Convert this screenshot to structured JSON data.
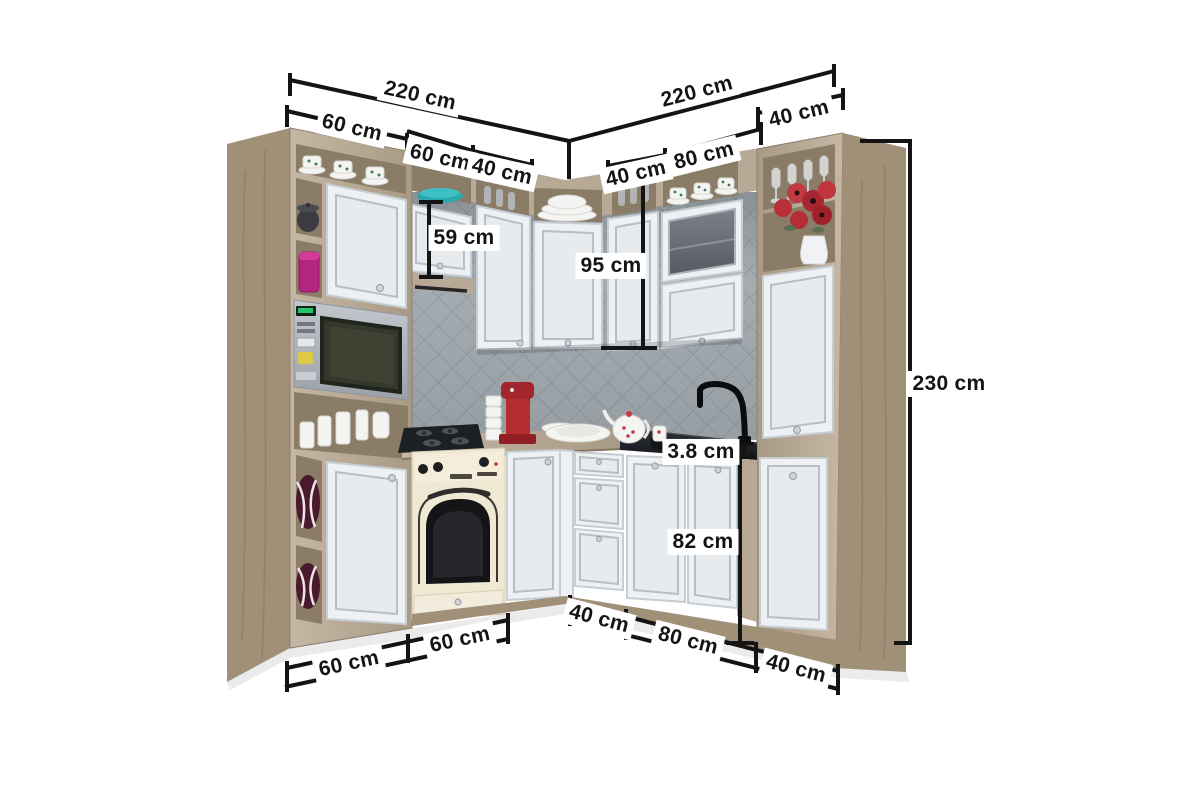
{
  "figure": {
    "type": "corner-kitchen-dimension-diagram",
    "units": "cm",
    "background": "#ffffff"
  },
  "palette": {
    "wood": "#b7a995",
    "wood_dark": "#a09078",
    "wood_interior": "#8a7c67",
    "cabinet_white": "#eef1f4",
    "cabinet_panel": "#e7ebee",
    "cabinet_frame": "#c6cdd3",
    "cabinet_frame2": "#b6bfc7",
    "backsplash_tile": "#a9b1b7",
    "backsplash_line": "#959da3",
    "counter_wood": "#b3a48e",
    "counter_black": "#1f2226",
    "oven_cream": "#efe8d3",
    "accent_teal": "#2aa9ad",
    "accent_magenta": "#b5257f",
    "accent_red": "#b72c31",
    "accent_maroon": "#4a1a2c",
    "annotation_black": "#141414",
    "label_bg": "#ffffff"
  },
  "dims": {
    "run_left": "220 cm",
    "run_right": "220 cm",
    "tall_left_width": "60 cm",
    "hob_cabinet_width": "60 cm",
    "wall_cabinet_width_left": "40 cm",
    "wall_cabinet_width_right": "40 cm",
    "glass_cabinet_width": "80 cm",
    "tall_right_width": "40 cm",
    "hob_cabinet_height": "59 cm",
    "wall_cabinet_height": "95 cm",
    "total_height": "230 cm",
    "worktop_thickness": "3.8 cm",
    "base_cabinet_height": "82 cm",
    "drawer_unit_width": "40 cm",
    "sink_cabinet_width": "80 cm",
    "tall_right_width_bottom": "40 cm",
    "base_left_width_a": "60 cm",
    "base_left_width_b": "60 cm"
  }
}
